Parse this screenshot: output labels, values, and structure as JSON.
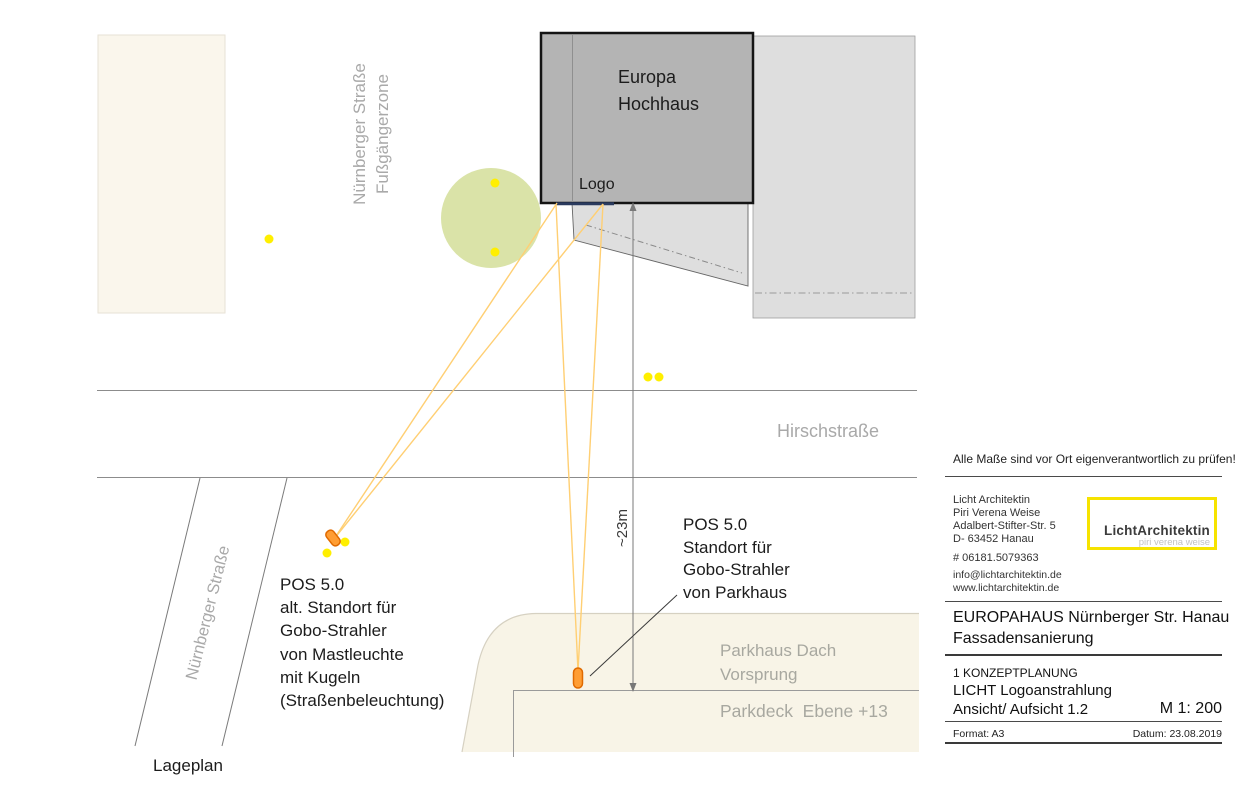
{
  "colors": {
    "building_dark": "#b4b4b4",
    "building_light": "#dedede",
    "paper_cream": "#faf6ec",
    "parkhaus_cream": "#f8f4e7",
    "tree_green": "#d8e2a3",
    "dot_yellow": "#ffef00",
    "beam_orange": "#ffcf73",
    "fixture_fill": "#ff9d33",
    "fixture_stroke": "#e06a00",
    "logo_border_yellow": "#f6e300",
    "street_gray": "#8c8c8c",
    "label_gray": "#a9a9a9"
  },
  "plan": {
    "building": {
      "name_line1": "Europa",
      "name_line2": "Hochhaus",
      "logo_label": "Logo"
    },
    "streets": {
      "pedestrian_line1": "Nürnberger Straße",
      "pedestrian_line2": "Fußgängerzone",
      "hirschstrasse": "Hirschstraße",
      "nuernberger": "Nürnberger Straße"
    },
    "dimension": {
      "label": "~23m"
    },
    "pos_parkhaus": {
      "line1": "POS 5.0",
      "line2": "Standort für",
      "line3": "Gobo-Strahler",
      "line4": "von Parkhaus"
    },
    "pos_alt": {
      "line1": "POS 5.0",
      "line2": "alt. Standort für",
      "line3": "Gobo-Strahler",
      "line4": "von Mastleuchte",
      "line5": "mit Kugeln",
      "line6": "(Straßenbeleuchtung)"
    },
    "parkhaus": {
      "roof_line1": "Parkhaus Dach",
      "roof_line2": "Vorsprung",
      "deck": "Parkdeck  Ebene +13"
    },
    "caption": "Lageplan"
  },
  "titleblock": {
    "notice": "Alle Maße sind vor Ort eigenverantwortlich zu prüfen!",
    "architect": {
      "line1": "Licht Architektin",
      "line2": "Piri Verena Weise",
      "line3": "Adalbert-Stifter-Str. 5",
      "line4": "D- 63452 Hanau",
      "phone": "# 06181.5079363",
      "email": "info@lichtarchitektin.de",
      "website": "www.lichtarchitektin.de"
    },
    "logo": {
      "name": "LichtArchitektin",
      "tagline": "piri verena weise"
    },
    "project": {
      "line1": "EUROPAHAUS Nürnberger Str. Hanau",
      "line2": "Fassadensanierung"
    },
    "drawing": {
      "phase": "1 KONZEPTPLANUNG",
      "title": "LICHT Logoanstrahlung",
      "subtitle": "Ansicht/ Aufsicht 1.2",
      "scale": "M 1: 200"
    },
    "meta": {
      "format": "Format: A3",
      "date": "Datum: 23.08.2019"
    }
  }
}
